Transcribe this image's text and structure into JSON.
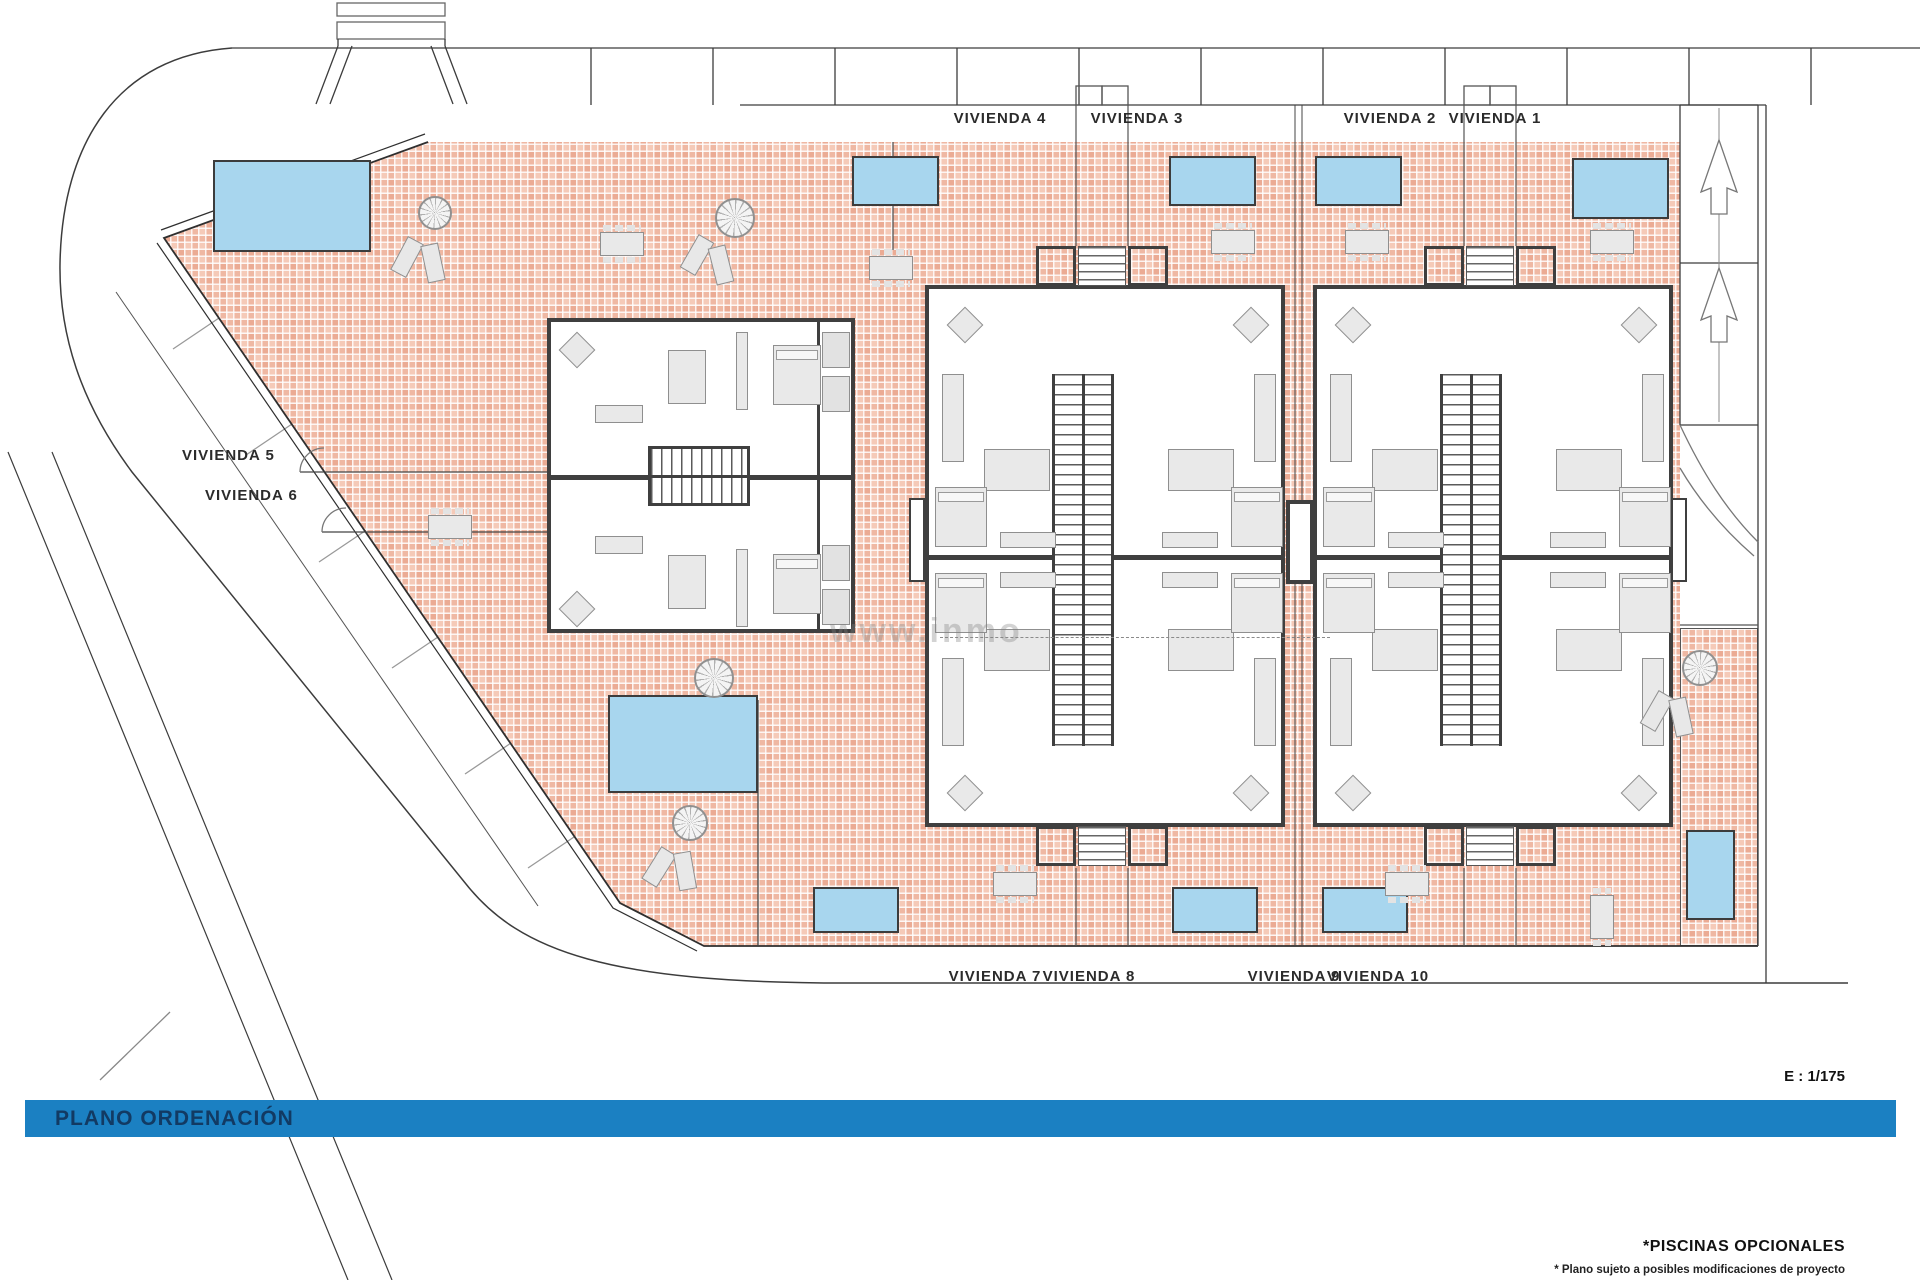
{
  "plan": {
    "viviendas": {
      "top": [
        "VIVIENDA 4",
        "VIVIENDA 3",
        "VIVIENDA 2",
        "VIVIENDA 1"
      ],
      "left": [
        "VIVIENDA 5",
        "VIVIENDA 6"
      ],
      "bottom": [
        "VIVIENDA 7",
        "VIVIENDA 8",
        "VIVIENDA 9",
        "VIVIENDA 10"
      ]
    },
    "scale_label": "E : 1/175",
    "watermark": "www.inmo",
    "notes": {
      "pools": "*PISCINAS OPCIONALES",
      "disclaimer": "* Plano sujeto a posibles modificaciones de proyecto"
    },
    "title_bar": {
      "label": "PLANO ORDENACIÓN"
    },
    "colors": {
      "terrace_tile": "#f5cab8",
      "pool": "#a8d6ee",
      "wall": "#3f3f3f",
      "furniture": "#e9e9e9",
      "banner": "#1b80c2",
      "banner_text": "#123a63"
    }
  }
}
